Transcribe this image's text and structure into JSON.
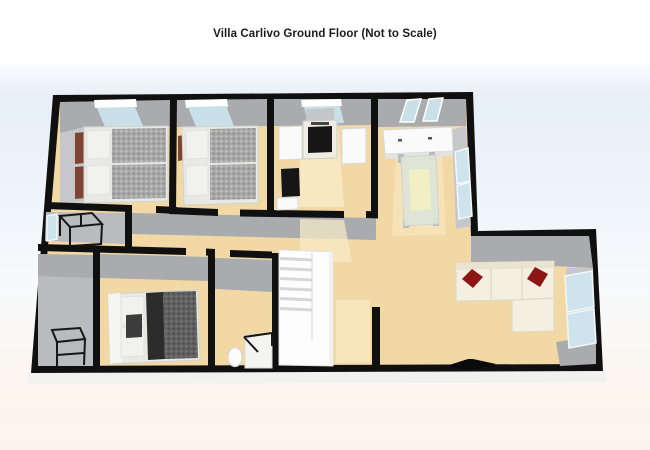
{
  "title": "Villa Carlivo Ground Floor (Not to Scale)",
  "colors": {
    "wall": "#101010",
    "wall_face": "#a9abae",
    "wall_face_light": "#c5c7ca",
    "floor": "#f2d8a4",
    "floor_light": "#f9ecc8",
    "floor_gray": "#b9bbbe",
    "window_glass": "#cfe3ec",
    "skylight": "#c9e0e9",
    "bed_linen": "#f1f1ef",
    "bed_blanket": "#a8a8a8",
    "bed_dark": "#616161",
    "bed_throw": "#2c2c2c",
    "wood_brown": "#7d4530",
    "sofa": "#f3efe1",
    "cushion_red": "#8e1515",
    "appliance_white": "#fafafa",
    "appliance_dark": "#161616",
    "glass_table": "#dde6d9",
    "glass_highlight": "#f6f1c2",
    "tv_black": "#0a0a0a",
    "frame_black": "#161616",
    "stair_white": "#fdfdfd",
    "stair_gap": "#d7d7d7",
    "exterior_base": "#f1f1ef"
  }
}
